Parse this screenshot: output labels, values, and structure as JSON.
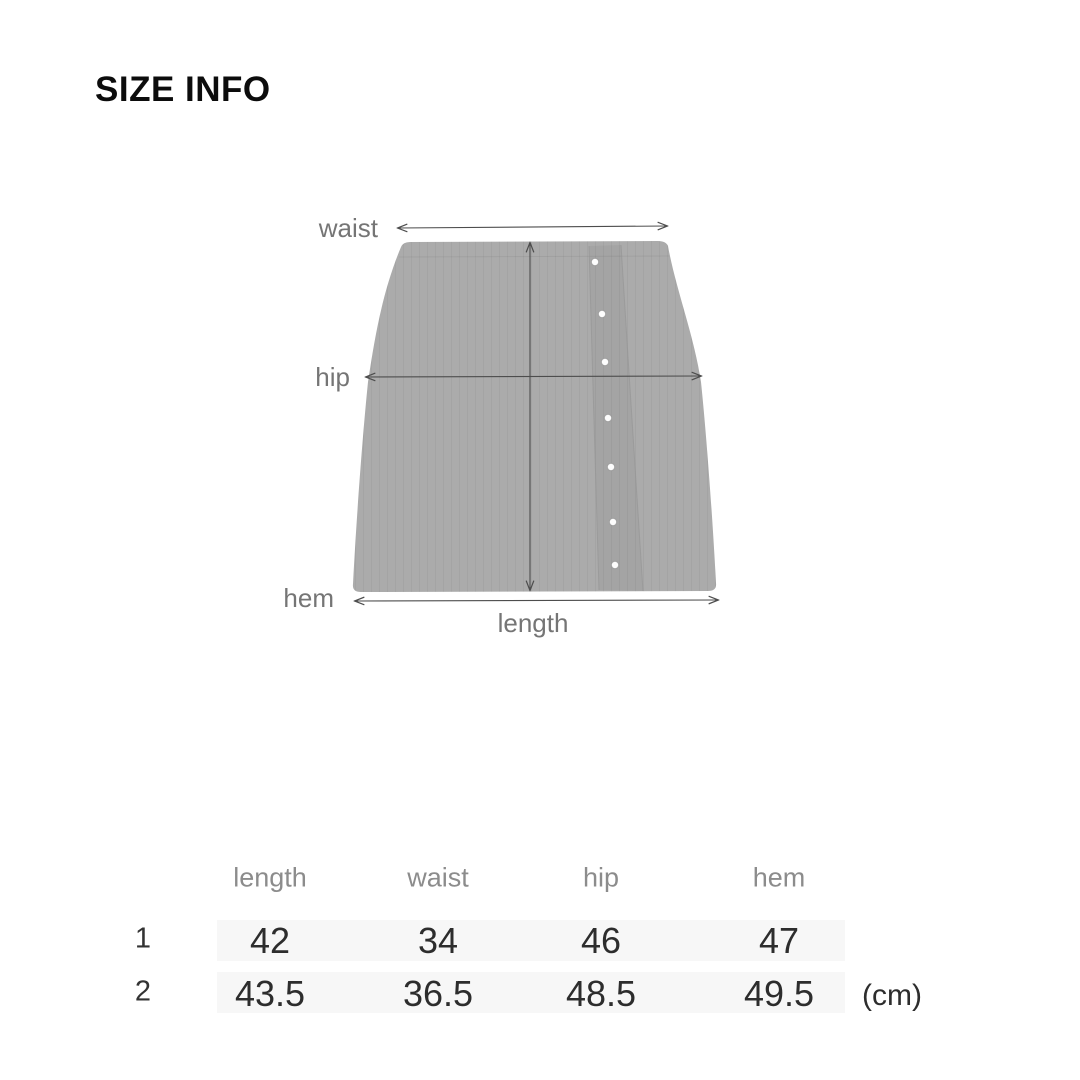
{
  "page": {
    "title": "SIZE INFO"
  },
  "diagram": {
    "garment": "cable-knit button-front mini skirt",
    "button_count": 7,
    "labels": {
      "waist": "waist",
      "hip": "hip",
      "hem": "hem",
      "length": "length"
    }
  },
  "size_table": {
    "columns": [
      "length",
      "waist",
      "hip",
      "hem"
    ],
    "rows": [
      {
        "label": "1",
        "values": [
          "42",
          "34",
          "46",
          "47"
        ]
      },
      {
        "label": "2",
        "values": [
          "43.5",
          "36.5",
          "48.5",
          "49.5"
        ]
      }
    ],
    "unit": "(cm)"
  },
  "colors": {
    "background": "#ffffff",
    "garment_fill": "#ababab",
    "measure_line": "#4d4d4d",
    "diagram_label": "#757575",
    "table_header": "#8c8c8c",
    "table_value": "#2d2d2d",
    "row_stripe": "#f7f7f7",
    "title": "#0c0c0c"
  }
}
